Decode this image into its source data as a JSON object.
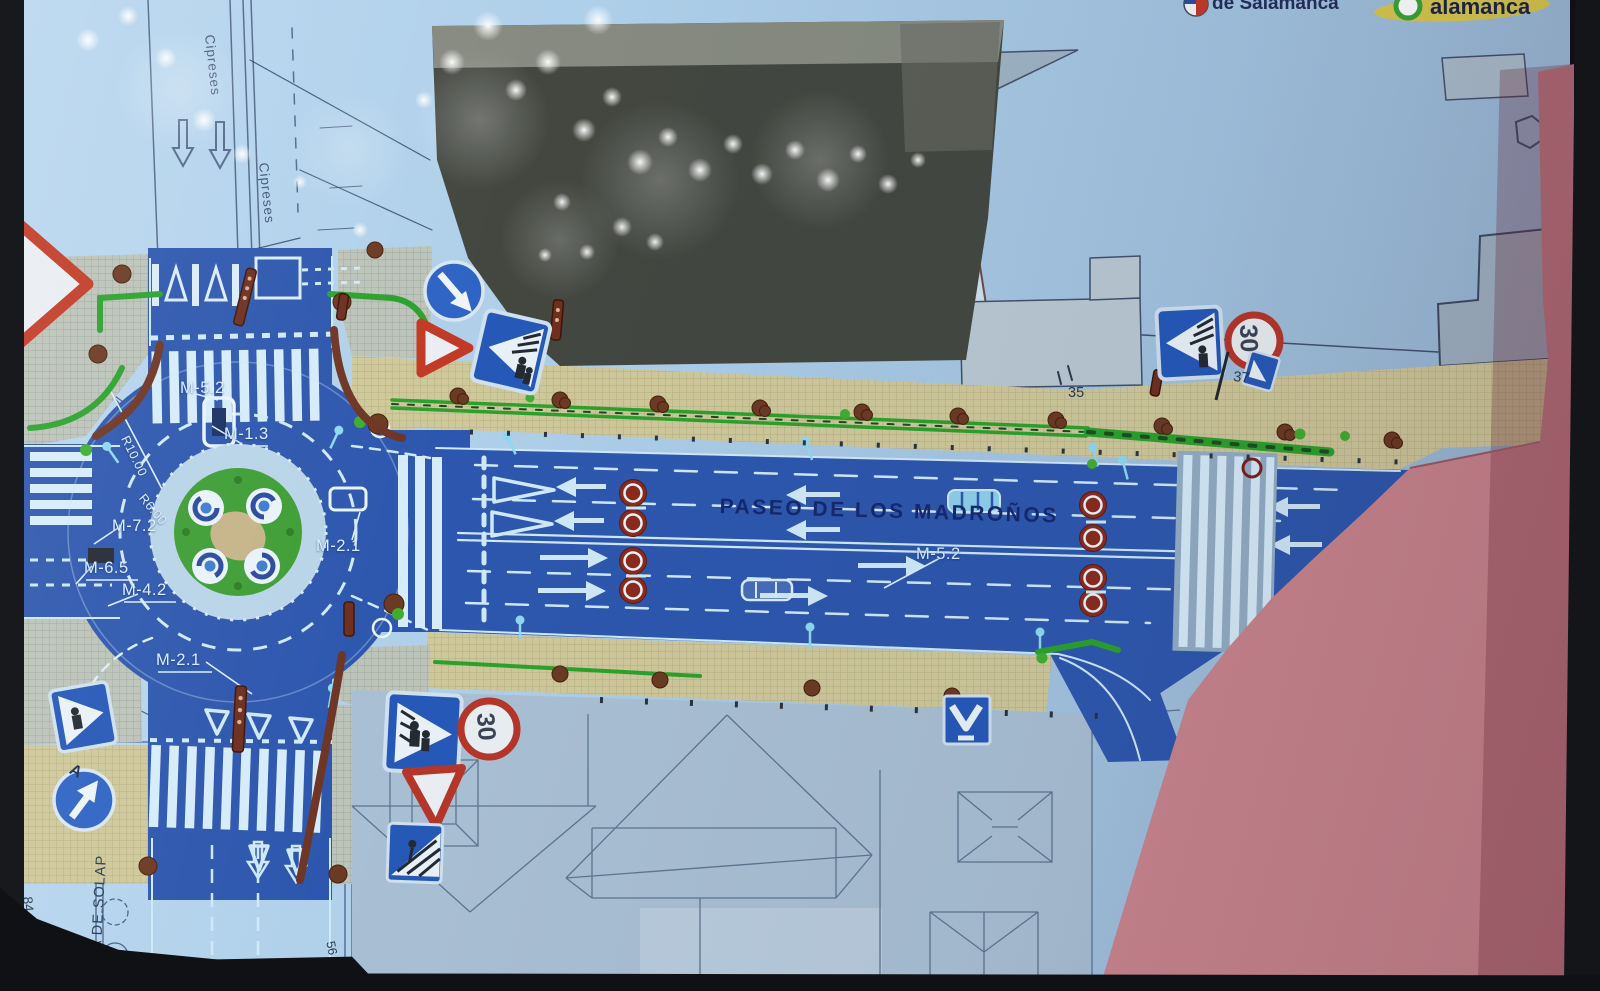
{
  "logos": {
    "left": {
      "text": "de Salamanca"
    },
    "right": {
      "text": "alamanca"
    }
  },
  "street_names": {
    "main_road": "PASEO DE LOS MADROÑOS",
    "cross_street_upper": "Cipreses",
    "cross_street_lower": "Cipreses"
  },
  "marking_labels": {
    "m52_roundabout": "M-5.2",
    "m13": "M-1.3",
    "m72": "M-7.2",
    "m65": "M-6.5",
    "m42": "M-4.2",
    "m21_east": "M-2.1",
    "m21_south": "M-2.1",
    "m52_road": "M-5.2"
  },
  "dimensions": {
    "outer_radius": "R10.00",
    "inner_radius": "R6.00"
  },
  "annotations": {
    "overlap_line": "LINEA DE SOLAP",
    "point_a": "A",
    "building_84_86": "84-86",
    "number_35": "35",
    "number_37": "37",
    "number_56": "56"
  },
  "signs": {
    "speed_limit_upper": "30",
    "speed_limit_lower": "30"
  },
  "colors": {
    "carriageway_blue": "#2d57ae",
    "sidewalk_tan": "#cfc89a",
    "bike_lane_green": "#2ba12c",
    "building_pink": "#c9858e",
    "building_gray": "#a9bfd3",
    "paper_blue": "#a9cbe6",
    "sign_red": "#b5352a",
    "sign_blue": "#2658b8",
    "marking_white": "#d6ecfa"
  }
}
